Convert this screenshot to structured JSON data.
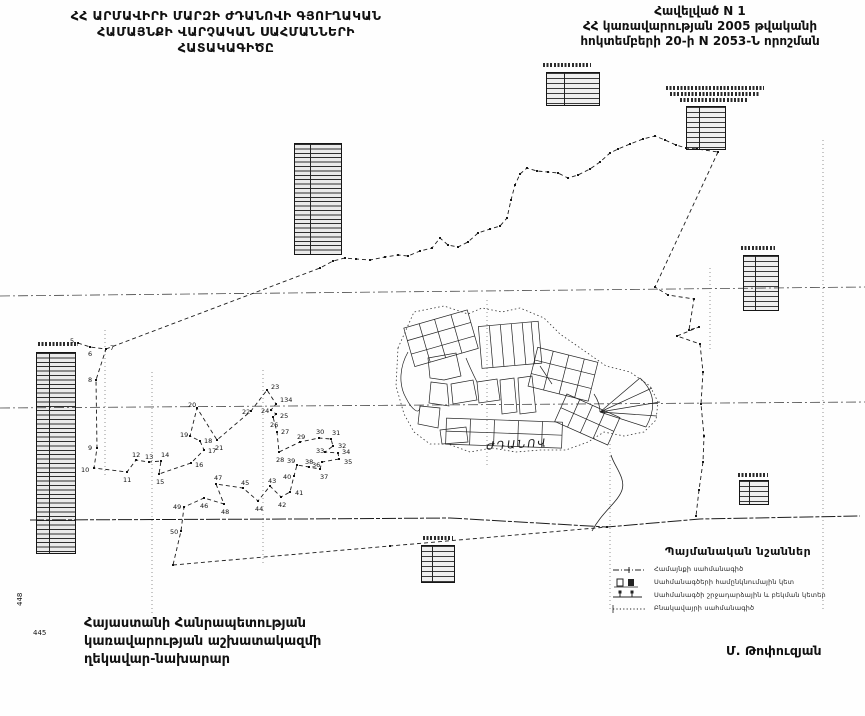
{
  "header": {
    "title_lines": [
      "ՀՀ ԱՐՄԱՎԻՐԻ ՄԱՐԶԻ ԺԴԱՆՈՎԻ ԳՅՈՒՂԱԿԱՆ",
      "ՀԱՄԱՅՆՔԻ ՎԱՐՉԱԿԱՆ  ՍԱՀՄԱՆՆԵՐԻ",
      "ՀԱՏԱԿԱԳԻԾԸ"
    ],
    "annex_lines": [
      "Հավելված  N 1",
      "ՀՀ կառավարության 2005 թվականի",
      "հոկտեմբերի 20-ի N 2053-Ն որոշման"
    ]
  },
  "map": {
    "settlement_label": "ԺԴԱՆՈՎ",
    "margin_numbers": [
      "448",
      "445"
    ],
    "points": [
      {
        "n": "5",
        "x": 78,
        "y": 343,
        "dx": -8,
        "dy": 0
      },
      {
        "n": "6",
        "x": 90,
        "y": 347,
        "dx": -2,
        "dy": 9
      },
      {
        "n": "7",
        "x": 106,
        "y": 349,
        "dx": 4,
        "dy": 1
      },
      {
        "n": "8",
        "x": 96,
        "y": 380,
        "dx": -8,
        "dy": 2
      },
      {
        "n": "9",
        "x": 97,
        "y": 448,
        "dx": -9,
        "dy": 2
      },
      {
        "n": "10",
        "x": 94,
        "y": 468,
        "dx": -13,
        "dy": 4
      },
      {
        "n": "11",
        "x": 127,
        "y": 472,
        "dx": -4,
        "dy": 10
      },
      {
        "n": "12",
        "x": 136,
        "y": 460,
        "dx": -4,
        "dy": -3
      },
      {
        "n": "13",
        "x": 149,
        "y": 462,
        "dx": -4,
        "dy": -3
      },
      {
        "n": "14",
        "x": 161,
        "y": 461,
        "dx": 0,
        "dy": -4
      },
      {
        "n": "15",
        "x": 159,
        "y": 474,
        "dx": -3,
        "dy": 10
      },
      {
        "n": "16",
        "x": 191,
        "y": 463,
        "dx": 4,
        "dy": 4
      },
      {
        "n": "17",
        "x": 204,
        "y": 450,
        "dx": 4,
        "dy": 3
      },
      {
        "n": "18",
        "x": 200,
        "y": 441,
        "dx": 4,
        "dy": 2
      },
      {
        "n": "19",
        "x": 190,
        "y": 436,
        "dx": -10,
        "dy": 1
      },
      {
        "n": "20",
        "x": 197,
        "y": 408,
        "dx": -9,
        "dy": -1
      },
      {
        "n": "21",
        "x": 217,
        "y": 440,
        "dx": -2,
        "dy": 10
      },
      {
        "n": "22",
        "x": 251,
        "y": 411,
        "dx": -9,
        "dy": 3
      },
      {
        "n": "23",
        "x": 267,
        "y": 390,
        "dx": 4,
        "dy": -1
      },
      {
        "n": "134",
        "x": 276,
        "y": 404,
        "dx": 4,
        "dy": -2
      },
      {
        "n": "24",
        "x": 271,
        "y": 410,
        "dx": -10,
        "dy": 3
      },
      {
        "n": "25",
        "x": 276,
        "y": 414,
        "dx": 4,
        "dy": 4
      },
      {
        "n": "26",
        "x": 273,
        "y": 417,
        "dx": -3,
        "dy": 10
      },
      {
        "n": "27",
        "x": 277,
        "y": 432,
        "dx": 4,
        "dy": 2
      },
      {
        "n": "28",
        "x": 279,
        "y": 452,
        "dx": -3,
        "dy": 10
      },
      {
        "n": "29",
        "x": 300,
        "y": 442,
        "dx": -3,
        "dy": -3
      },
      {
        "n": "30",
        "x": 319,
        "y": 438,
        "dx": -3,
        "dy": -4
      },
      {
        "n": "31",
        "x": 331,
        "y": 439,
        "dx": 1,
        "dy": -4
      },
      {
        "n": "32",
        "x": 333,
        "y": 446,
        "dx": 5,
        "dy": 2
      },
      {
        "n": "33",
        "x": 325,
        "y": 452,
        "dx": -9,
        "dy": 1
      },
      {
        "n": "34",
        "x": 338,
        "y": 453,
        "dx": 4,
        "dy": 1
      },
      {
        "n": "35",
        "x": 339,
        "y": 459,
        "dx": 5,
        "dy": 5
      },
      {
        "n": "36",
        "x": 322,
        "y": 462,
        "dx": -10,
        "dy": 5
      },
      {
        "n": "37",
        "x": 320,
        "y": 469,
        "dx": 0,
        "dy": 10
      },
      {
        "n": "38",
        "x": 309,
        "y": 467,
        "dx": -4,
        "dy": -3
      },
      {
        "n": "39",
        "x": 297,
        "y": 465,
        "dx": -10,
        "dy": -2
      },
      {
        "n": "40",
        "x": 294,
        "y": 476,
        "dx": -11,
        "dy": 3
      },
      {
        "n": "41",
        "x": 290,
        "y": 492,
        "dx": 5,
        "dy": 3
      },
      {
        "n": "42",
        "x": 281,
        "y": 497,
        "dx": -3,
        "dy": 10
      },
      {
        "n": "43",
        "x": 270,
        "y": 486,
        "dx": -2,
        "dy": -3
      },
      {
        "n": "44",
        "x": 258,
        "y": 501,
        "dx": -3,
        "dy": 10
      },
      {
        "n": "45",
        "x": 243,
        "y": 488,
        "dx": -2,
        "dy": -3
      },
      {
        "n": "46",
        "x": 204,
        "y": 498,
        "dx": -4,
        "dy": 10
      },
      {
        "n": "47",
        "x": 216,
        "y": 484,
        "dx": -2,
        "dy": -4
      },
      {
        "n": "48",
        "x": 224,
        "y": 504,
        "dx": -3,
        "dy": 10
      },
      {
        "n": "49",
        "x": 184,
        "y": 507,
        "dx": -11,
        "dy": 2
      },
      {
        "n": "50",
        "x": 181,
        "y": 531,
        "dx": -11,
        "dy": 3
      }
    ],
    "geometry": {
      "chains": [
        {
          "style": "dash",
          "ticks": true,
          "pts": [
            [
              106,
              349
            ],
            [
              320,
              268
            ],
            [
              333,
              261
            ],
            [
              345,
              258
            ],
            [
              356,
              259
            ],
            [
              370,
              260
            ],
            [
              385,
              257
            ],
            [
              398,
              255
            ],
            [
              408,
              256
            ],
            [
              420,
              251
            ],
            [
              432,
              248
            ],
            [
              440,
              238
            ],
            [
              448,
              245
            ],
            [
              458,
              247
            ],
            [
              468,
              242
            ],
            [
              478,
              233
            ],
            [
              490,
              229
            ],
            [
              500,
              226
            ],
            [
              507,
              218
            ],
            [
              511,
              200
            ],
            [
              515,
              185
            ],
            [
              520,
              174
            ],
            [
              527,
              168
            ],
            [
              537,
              171
            ],
            [
              548,
              172
            ],
            [
              558,
              173
            ],
            [
              568,
              178
            ],
            [
              578,
              175
            ],
            [
              590,
              169
            ],
            [
              600,
              162
            ],
            [
              610,
              153
            ],
            [
              618,
              149
            ],
            [
              630,
              144
            ],
            [
              643,
              139
            ],
            [
              655,
              136
            ],
            [
              665,
              140
            ],
            [
              676,
              145
            ],
            [
              686,
              148
            ],
            [
              697,
              149
            ],
            [
              718,
              152
            ]
          ]
        },
        {
          "style": "dash",
          "ticks": true,
          "pts": [
            [
              718,
              152
            ],
            [
              655,
              287
            ],
            [
              668,
              295
            ],
            [
              694,
              299
            ],
            [
              689,
              330
            ],
            [
              699,
              327
            ],
            [
              677,
              336
            ],
            [
              700,
              344
            ],
            [
              703,
              372
            ],
            [
              701,
              404
            ],
            [
              704,
              436
            ],
            [
              703,
              462
            ],
            [
              699,
              490
            ],
            [
              696,
              516
            ]
          ]
        },
        {
          "style": "dash",
          "ticks": true,
          "pts": [
            [
              78,
              343
            ],
            [
              90,
              347
            ],
            [
              106,
              349
            ],
            [
              96,
              380
            ],
            [
              97,
              448
            ],
            [
              94,
              468
            ],
            [
              127,
              472
            ],
            [
              136,
              460
            ],
            [
              149,
              462
            ],
            [
              161,
              461
            ],
            [
              159,
              474
            ],
            [
              191,
              463
            ],
            [
              204,
              450
            ],
            [
              200,
              441
            ],
            [
              190,
              436
            ],
            [
              197,
              408
            ],
            [
              217,
              440
            ],
            [
              251,
              411
            ],
            [
              267,
              390
            ],
            [
              276,
              404
            ],
            [
              271,
              410
            ],
            [
              276,
              414
            ],
            [
              273,
              417
            ],
            [
              277,
              432
            ],
            [
              279,
              452
            ],
            [
              300,
              442
            ],
            [
              319,
              438
            ],
            [
              331,
              439
            ],
            [
              333,
              446
            ],
            [
              325,
              452
            ],
            [
              338,
              453
            ],
            [
              339,
              459
            ],
            [
              322,
              462
            ],
            [
              320,
              469
            ],
            [
              309,
              467
            ],
            [
              297,
              465
            ],
            [
              294,
              476
            ],
            [
              290,
              492
            ],
            [
              281,
              497
            ],
            [
              270,
              486
            ],
            [
              258,
              501
            ],
            [
              243,
              488
            ],
            [
              216,
              484
            ],
            [
              224,
              504
            ],
            [
              204,
              498
            ],
            [
              184,
              507
            ],
            [
              181,
              531
            ],
            [
              173,
              565
            ]
          ]
        },
        {
          "style": "dash",
          "ticks": true,
          "pts": [
            [
              173,
              565
            ],
            [
              390,
              546
            ],
            [
              607,
              527
            ]
          ]
        },
        {
          "style": "long",
          "ticks": false,
          "pts": [
            [
              30,
              520
            ],
            [
              300,
              519
            ],
            [
              450,
              518
            ],
            [
              607,
              527
            ],
            [
              700,
              519
            ],
            [
              860,
              516
            ]
          ]
        }
      ]
    }
  },
  "legend": {
    "title": "Պայմանական նշաններ",
    "items": [
      {
        "label": "Համայնքի սահմանագիծ"
      },
      {
        "label": "Սահմանագծերի համընկնումային կետ"
      },
      {
        "label": "Սահմանագծի շրջադարձային և բեկման կետեր"
      },
      {
        "label": "Բնակավայրի սահմանագիծ"
      }
    ]
  },
  "footer": {
    "left_lines": [
      "Հայաստանի Հանրապետության",
      "կառավարության աշխատակազմի",
      "ղեկավար-նախարար"
    ],
    "signature": "Մ. Թոփուզյան"
  }
}
